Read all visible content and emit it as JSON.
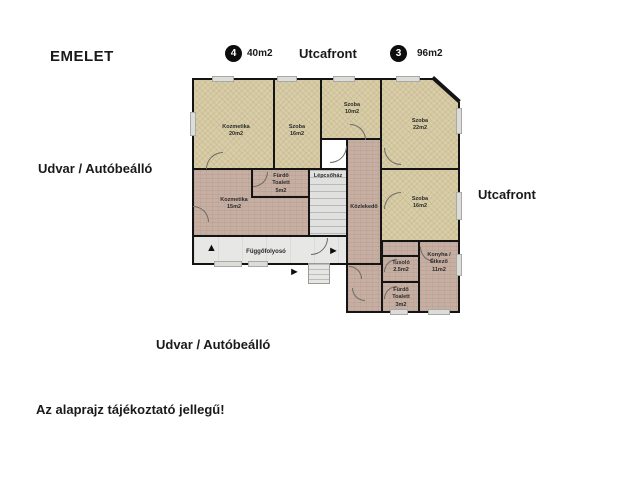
{
  "header": {
    "title": "EMELET",
    "unit4_badge": "4",
    "unit4_area": "40m2",
    "street_top": "Utcafront",
    "unit3_badge": "3",
    "unit3_area": "96m2"
  },
  "outer_labels": {
    "left": "Udvar / Autóbeálló",
    "right": "Utcafront",
    "bottom": "Udvar / Autóbeálló",
    "disclaimer": "Az alaprajz tájékoztató jellegű!"
  },
  "rooms": [
    {
      "name": "Kozmetika",
      "area": "20m2"
    },
    {
      "name": "Szoba",
      "area": "16m2"
    },
    {
      "name": "Szoba",
      "area": "10m2"
    },
    {
      "name": "Szoba",
      "area": "22m2"
    },
    {
      "name": "Fürdő\nToalett",
      "area": "5m2"
    },
    {
      "name": "Lépcsőház",
      "area": ""
    },
    {
      "name": "Kozmetika",
      "area": "15m2"
    },
    {
      "name": "Közlekedő",
      "area": ""
    },
    {
      "name": "Szoba",
      "area": "16m2"
    },
    {
      "name": "Függőfolyosó",
      "area": ""
    },
    {
      "name": "Tusoló",
      "area": "2.5m2"
    },
    {
      "name": "Konyha /\nÉtkező",
      "area": "11m2"
    },
    {
      "name": "Fürdő\nToalett",
      "area": "3m2"
    }
  ],
  "icons": {
    "arrow_up": "▲",
    "arrow_right": "►"
  },
  "colors": {
    "wall": "#141414",
    "room_beige": "#d8cda7",
    "room_pink": "#c6afa2",
    "floor_grey": "#e7e7e5",
    "background": "#ffffff"
  }
}
